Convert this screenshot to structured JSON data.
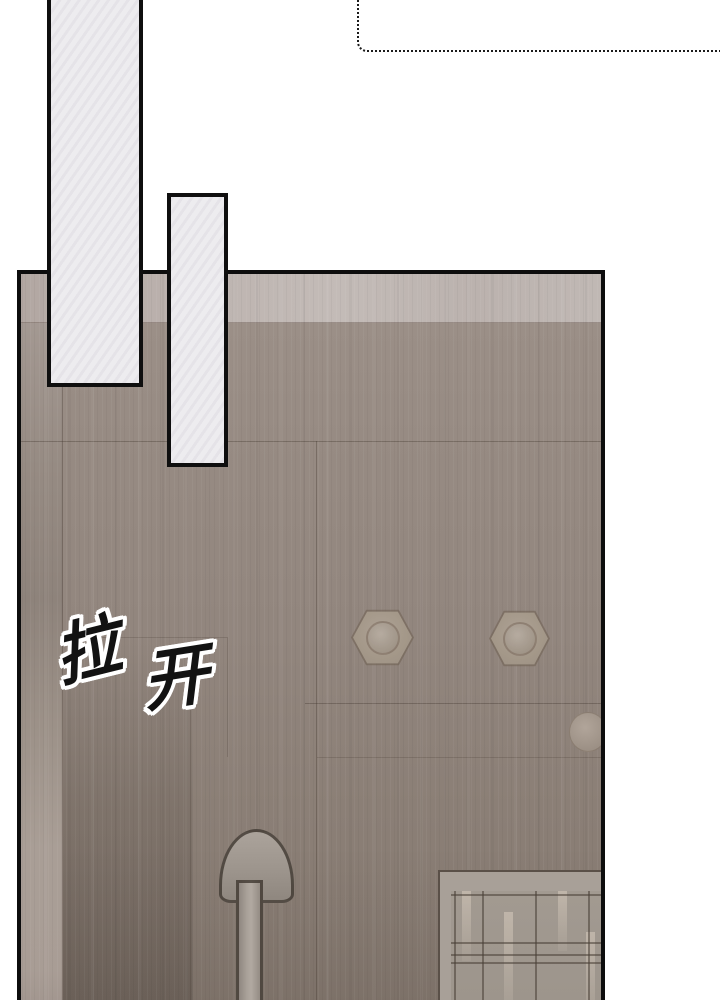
{
  "page": {
    "sfx_text": {
      "full": "拉开",
      "char_1": "拉",
      "char_2": "开"
    },
    "palette": {
      "background": "#ffffff",
      "line_black": "#0d0d0d",
      "bubble_fill": "#edecef",
      "door_face": "#94887f",
      "door_top_band": "#beb5b1",
      "door_left_frame": "#a79c94",
      "door_dark_corner": "#7b7068",
      "hardware_metal": "#a3978c",
      "window_frame": "#a8a098",
      "window_pane": "#9f978e",
      "window_grid_line": "#56504a"
    }
  }
}
